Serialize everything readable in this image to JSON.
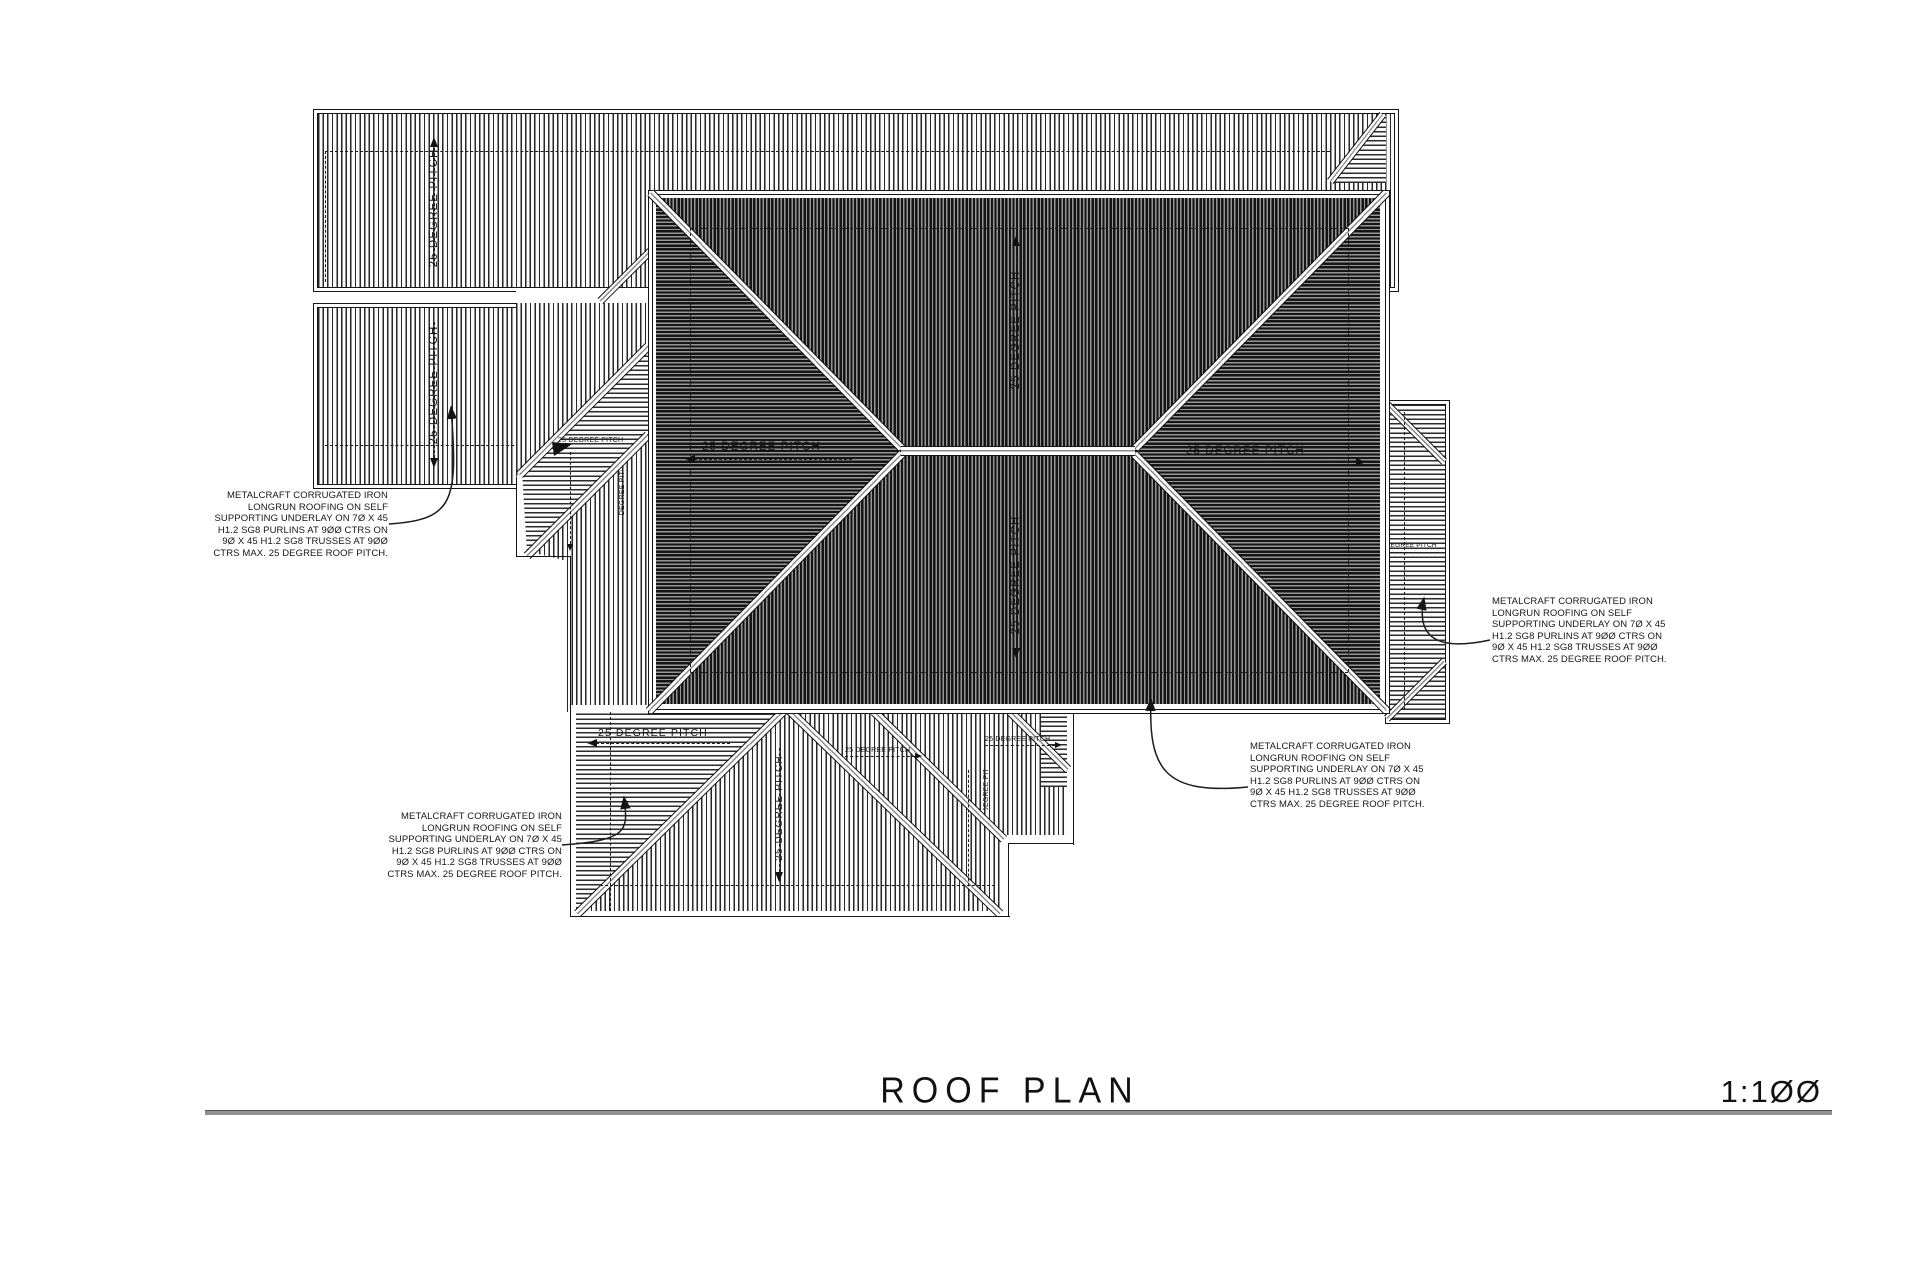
{
  "drawing_title": "ROOF PLAN",
  "drawing_scale": "1:1ØØ",
  "pitch_label": "25 DEGREE PITCH",
  "note": [
    "METALCRAFT CORRUGATED IRON",
    "LONGRUN ROOFING ON SELF",
    "SUPPORTING UNDERLAY ON 7Ø X 45",
    "H1.2 SG8 PURLINS AT 9ØØ CTRS ON",
    "9Ø X 45 H1.2 SG8 TRUSSES AT 9ØØ",
    "CTRS MAX. 25 DEGREE ROOF PITCH."
  ],
  "colors": {
    "ink": "#161616",
    "paper": "#ffffff",
    "rule_gray": "#8f8f8f",
    "hatch_gap_dark": "#969696"
  }
}
